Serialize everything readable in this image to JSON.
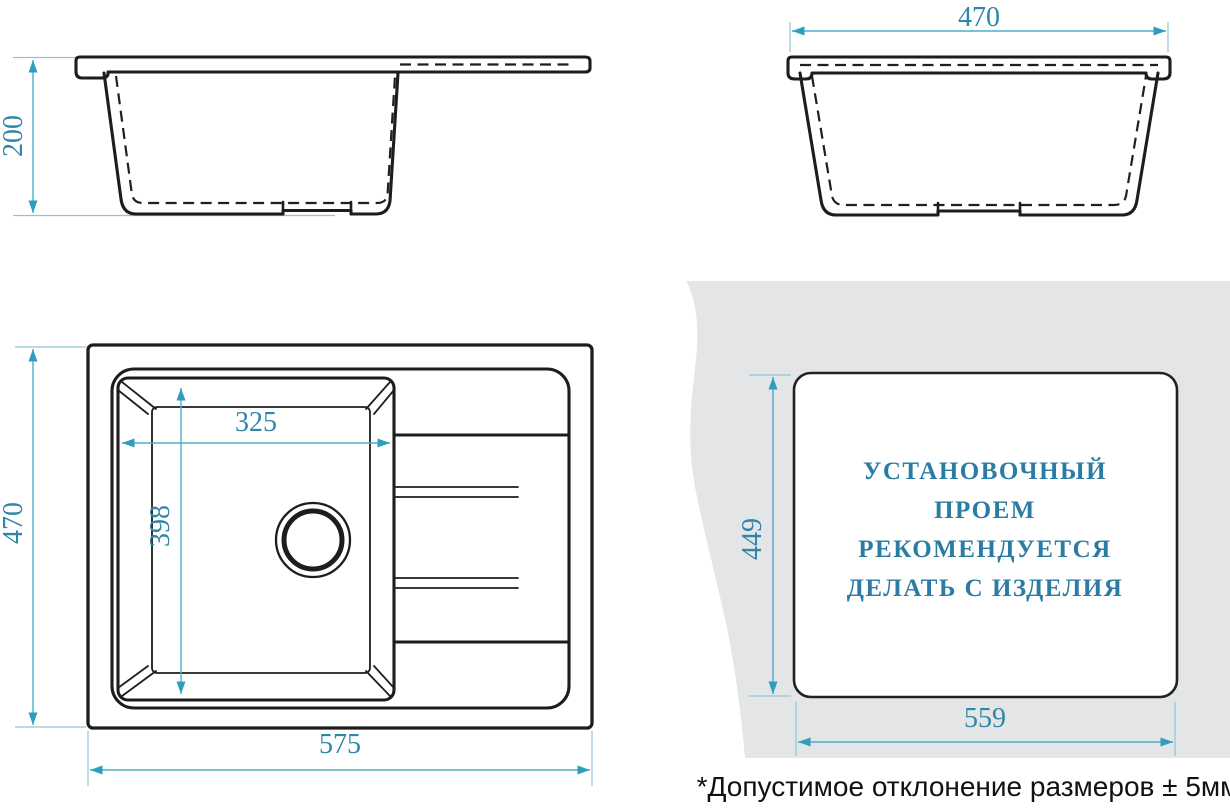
{
  "drawing": {
    "type": "technical-drawing",
    "subject": "kitchen sink with drainboard — dimensioned views and installation cutout"
  },
  "side_view": {
    "dim_depth": "200"
  },
  "front_view": {
    "dim_width": "470"
  },
  "top_view": {
    "dim_width": "470",
    "dim_length": "575",
    "bowl_width": "325",
    "bowl_length": "398"
  },
  "install_view": {
    "cutout_height": "449",
    "cutout_width": "559",
    "note_lines": [
      "УСТАНОВОЧНЫЙ",
      "ПРОЕМ",
      "РЕКОМЕНДУЕТСЯ",
      "ДЕЛАТЬ С ИЗДЕЛИЯ"
    ]
  },
  "footer": {
    "tolerance_note": "*Допустимое отклонение размеров ± 5мм"
  },
  "colors": {
    "line": "#1d1d1d",
    "dimension_line": "#4fadc9",
    "arrow": "#2f9dbe",
    "dimension_text": "#2e86a8",
    "note_text": "#2b7ca4",
    "countertop": "#e3e5e7"
  }
}
